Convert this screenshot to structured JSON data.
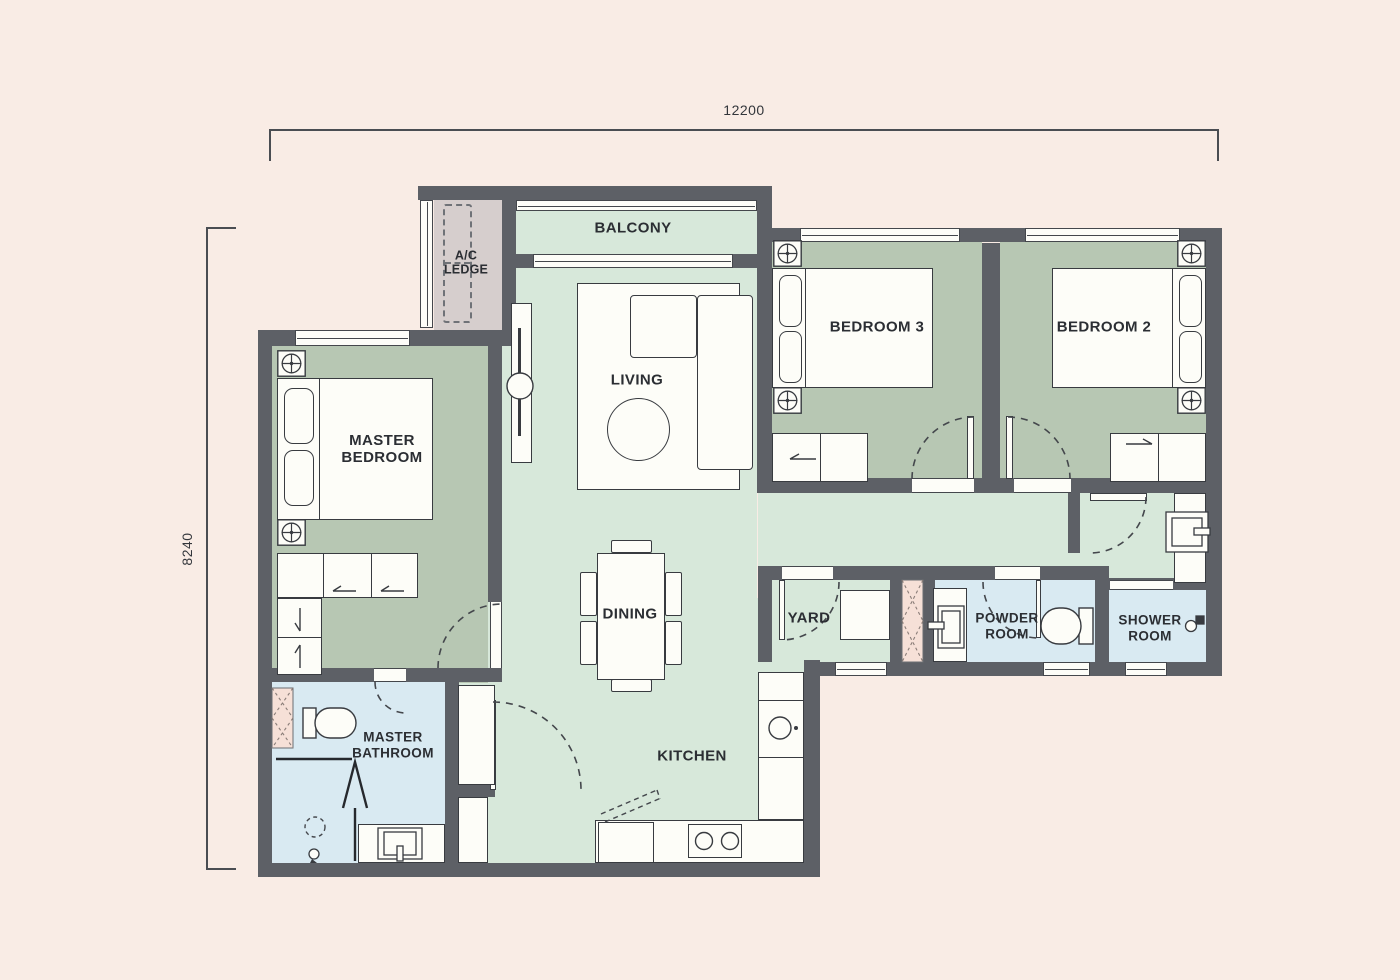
{
  "plan": {
    "dimensions": {
      "width_label": "12200",
      "height_label": "8240"
    },
    "rooms": {
      "balcony": "BALCONY",
      "ac_ledge_line1": "A/C",
      "ac_ledge_line2": "LEDGE",
      "living": "LIVING",
      "dining": "DINING",
      "kitchen": "KITCHEN",
      "yard": "YARD",
      "master_bedroom_line1": "MASTER",
      "master_bedroom_line2": "BEDROOM",
      "bedroom3": "BEDROOM 3",
      "bedroom2": "BEDROOM 2",
      "master_bathroom_line1": "MASTER",
      "master_bathroom_line2": "BATHROOM",
      "powder_room_line1": "POWDER",
      "powder_room_line2": "ROOM",
      "shower_room_line1": "SHOWER",
      "shower_room_line2": "ROOM"
    },
    "colors": {
      "background": "#f9ece5",
      "wall": "#5d6066",
      "floor_common": "#d7e8da",
      "floor_bedroom": "#b7c7b3",
      "floor_bathroom": "#d9eaf2",
      "ac_ledge": "#d6cecd",
      "shaft": "#f6e0d7",
      "furniture": "#fdfdf8",
      "line": "#3b3e43"
    }
  }
}
